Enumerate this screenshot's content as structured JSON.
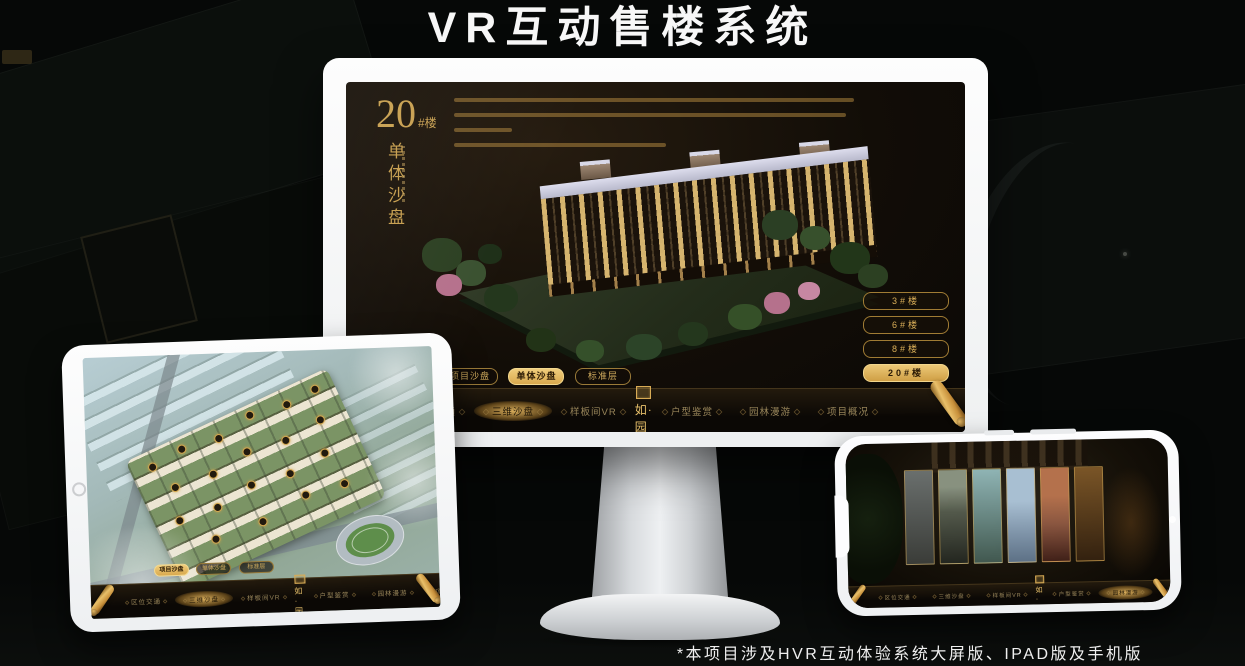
{
  "title": "VR互动售楼系统",
  "footnote": "*本项目涉及HVR互动体验系统大屏版、IPAD版及手机版",
  "logo": {
    "name": "如·园"
  },
  "nav": {
    "items": [
      "区位交通",
      "三维沙盘",
      "样板间VR",
      "户型鉴赏",
      "园林漫游",
      "项目概况"
    ]
  },
  "sub_tabs": [
    "项目沙盘",
    "单体沙盘",
    "标准层"
  ],
  "monitor": {
    "heading_number": "20",
    "heading_unit": "#楼",
    "heading_title": "单体沙盘",
    "floor_buttons": [
      "3#楼",
      "6#楼",
      "8#楼",
      "20#楼"
    ],
    "active_floor": "20#楼",
    "active_sub_tab": "单体沙盘",
    "active_nav": "三维沙盘"
  },
  "tablet": {
    "active_sub_tab": "项目沙盘",
    "active_nav": "三维沙盘"
  },
  "phone": {
    "active_nav": "园林漫游",
    "scene_panel_count": 6
  },
  "colors": {
    "gold": "#c99e50",
    "gold_bright": "#e9c472",
    "screen_bg": "#14100a",
    "title_white": "#f7f7f7"
  }
}
